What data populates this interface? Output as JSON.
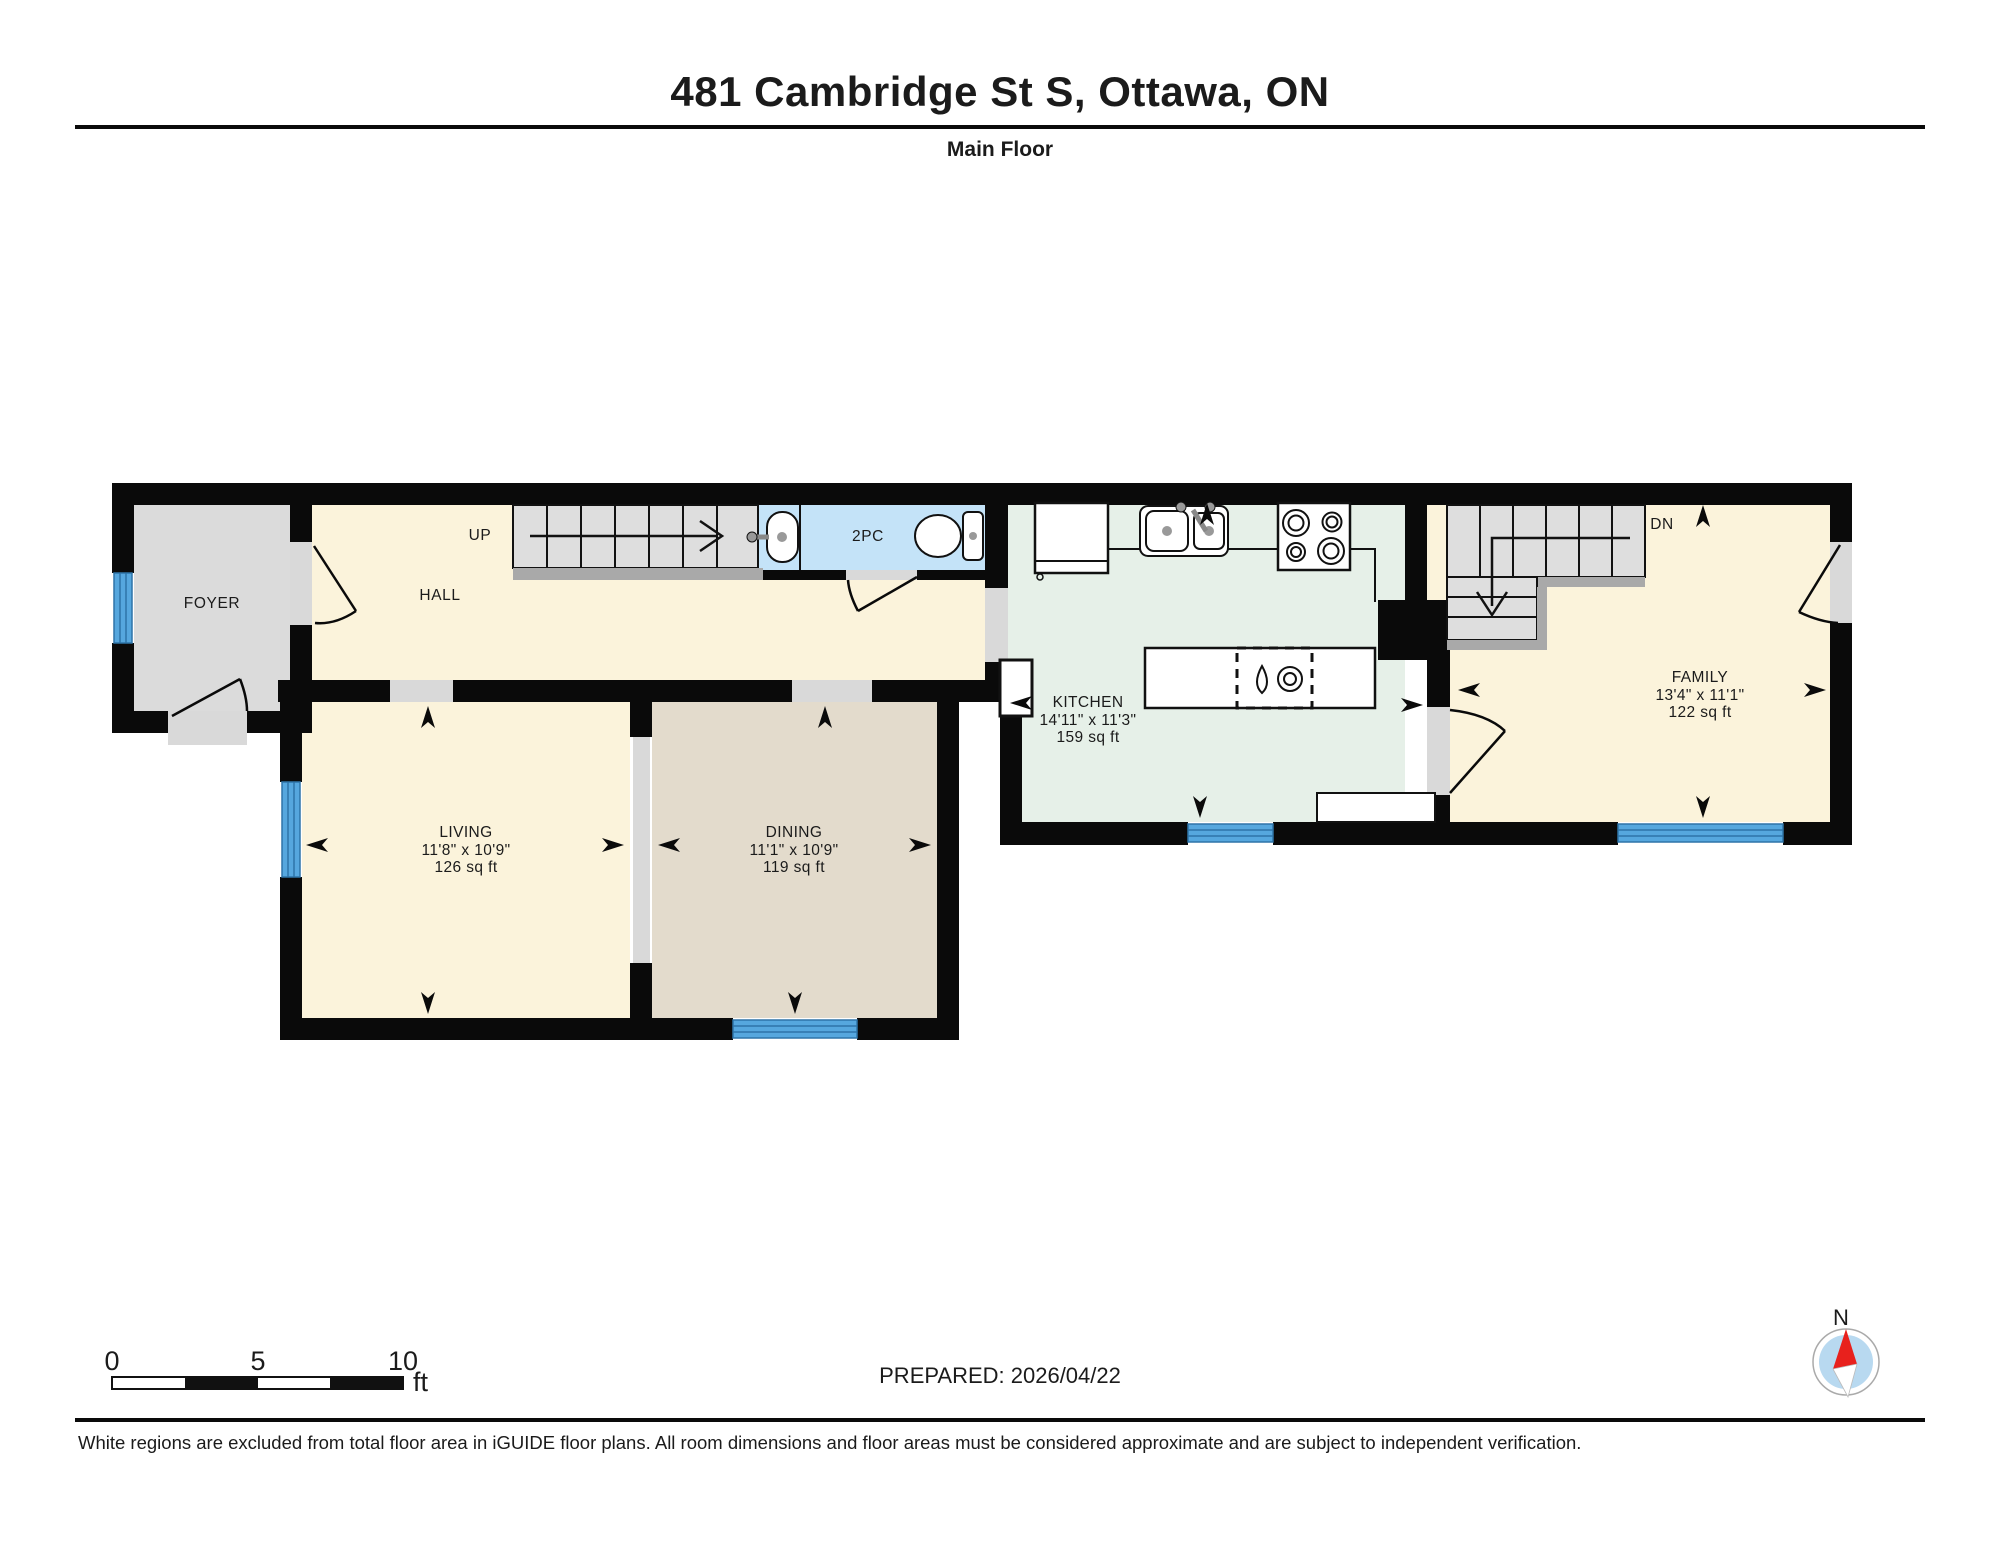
{
  "header": {
    "title": "481 Cambridge St S, Ottawa, ON",
    "subtitle": "Main Floor"
  },
  "rooms": {
    "foyer": {
      "name": "FOYER"
    },
    "hall": {
      "name": "HALL"
    },
    "bath": {
      "name": "2PC"
    },
    "kitchen": {
      "name": "KITCHEN",
      "dimensions": "14'11\" x 11'3\"",
      "area": "159 sq ft"
    },
    "family": {
      "name": "FAMILY",
      "dimensions": "13'4\" x 11'1\"",
      "area": "122 sq ft"
    },
    "living": {
      "name": "LIVING",
      "dimensions": "11'8\" x 10'9\"",
      "area": "126 sq ft"
    },
    "dining": {
      "name": "DINING",
      "dimensions": "11'1\" x 10'9\"",
      "area": "119 sq ft"
    }
  },
  "stairs": {
    "up": "UP",
    "down": "DN"
  },
  "scale_bar": {
    "ticks": [
      "0",
      "5",
      "10"
    ],
    "unit": "ft"
  },
  "compass": {
    "north": "N"
  },
  "footer": {
    "prepared": "PREPARED: 2026/04/22",
    "disclaimer": "White regions are excluded from total floor area in iGUIDE floor plans. All room dimensions and floor areas must be considered approximate and are subject to independent verification."
  },
  "colors": {
    "room_cream": "#FBF3DB",
    "room_tan": "#E3DBCC",
    "room_green": "#E6F0E8",
    "bath_blue": "#C4E3F8",
    "foyer_gray": "#DBDBDB",
    "opening_gray": "#D9D9D9",
    "stair_gray": "#DEDEDE",
    "window_blue": "#56A7DE",
    "wall_black": "#0A0A0A",
    "compass_red": "#E8211D"
  }
}
